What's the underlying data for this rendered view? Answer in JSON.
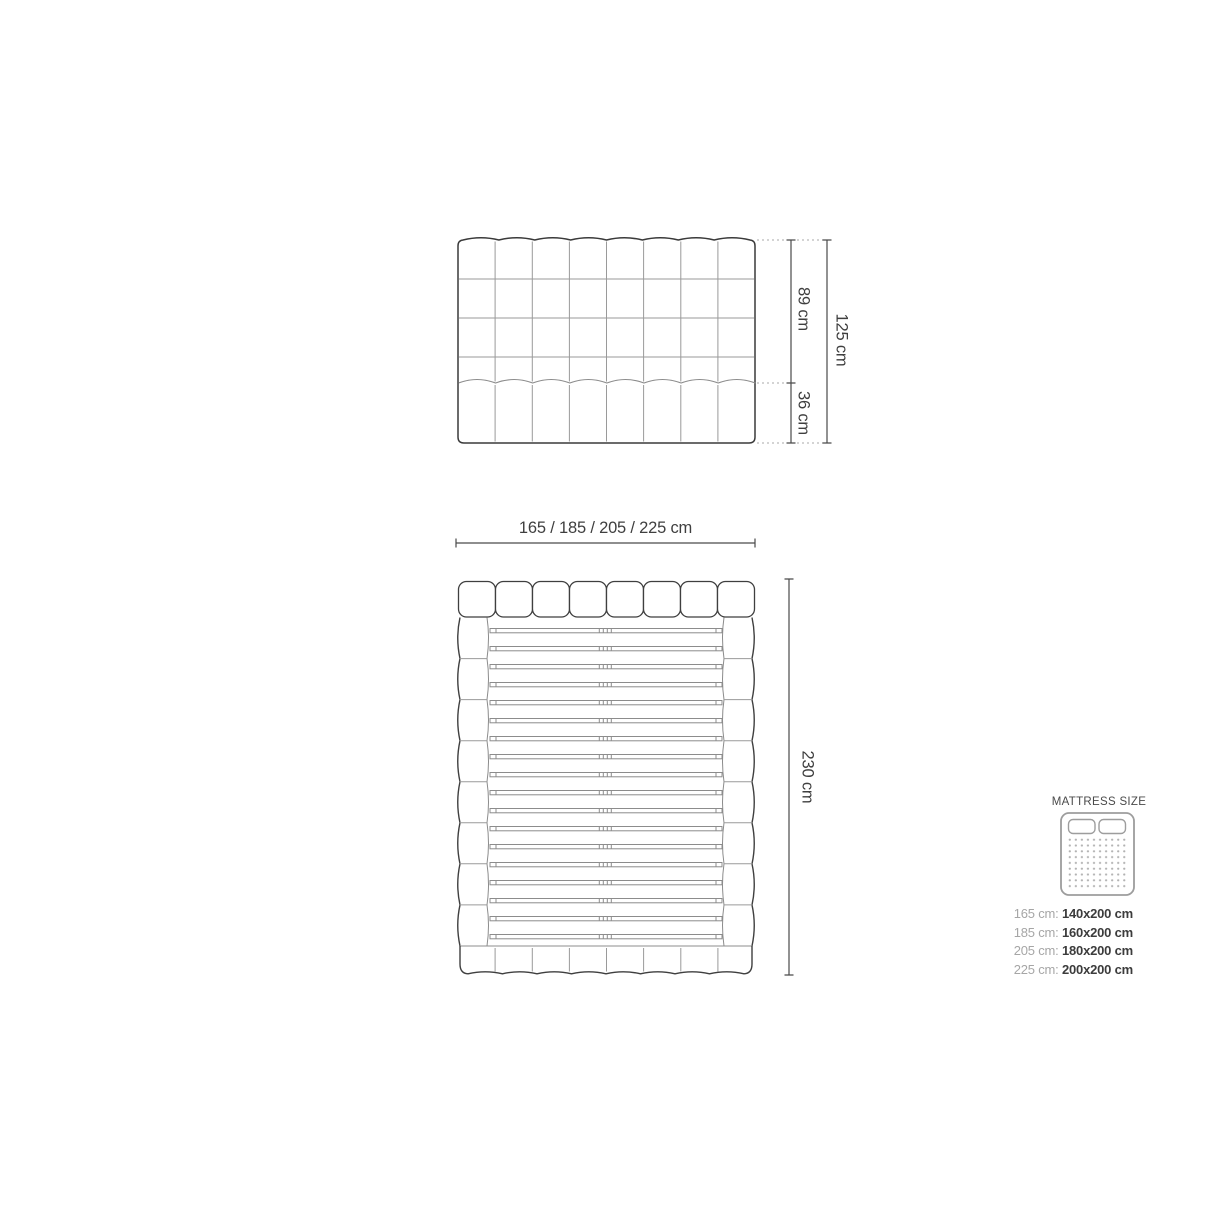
{
  "diagram": {
    "front_view": {
      "upper_height": "89 cm",
      "lower_height": "36 cm",
      "total_height": "125 cm"
    },
    "top_view": {
      "widths": "165 / 185 / 205 / 225 cm",
      "length": "230 cm"
    },
    "legend": {
      "title": "MATTRESS SIZE",
      "rows": [
        {
          "label": "165 cm:",
          "value": "140x200 cm"
        },
        {
          "label": "185 cm:",
          "value": "160x200 cm"
        },
        {
          "label": "205 cm:",
          "value": "180x200 cm"
        },
        {
          "label": "225 cm:",
          "value": "200x200 cm"
        }
      ]
    },
    "colors": {
      "outline": "#3a3a3a",
      "inner_line": "#9a9a9a",
      "scallop_line": "#8c8c8c",
      "dimension_line": "#4a4a4a",
      "dashed_line": "#a8a8a8",
      "text_dark": "#3f3f3f",
      "text_light": "#a6a6a6",
      "icon_gray": "#9d9d9d"
    }
  }
}
